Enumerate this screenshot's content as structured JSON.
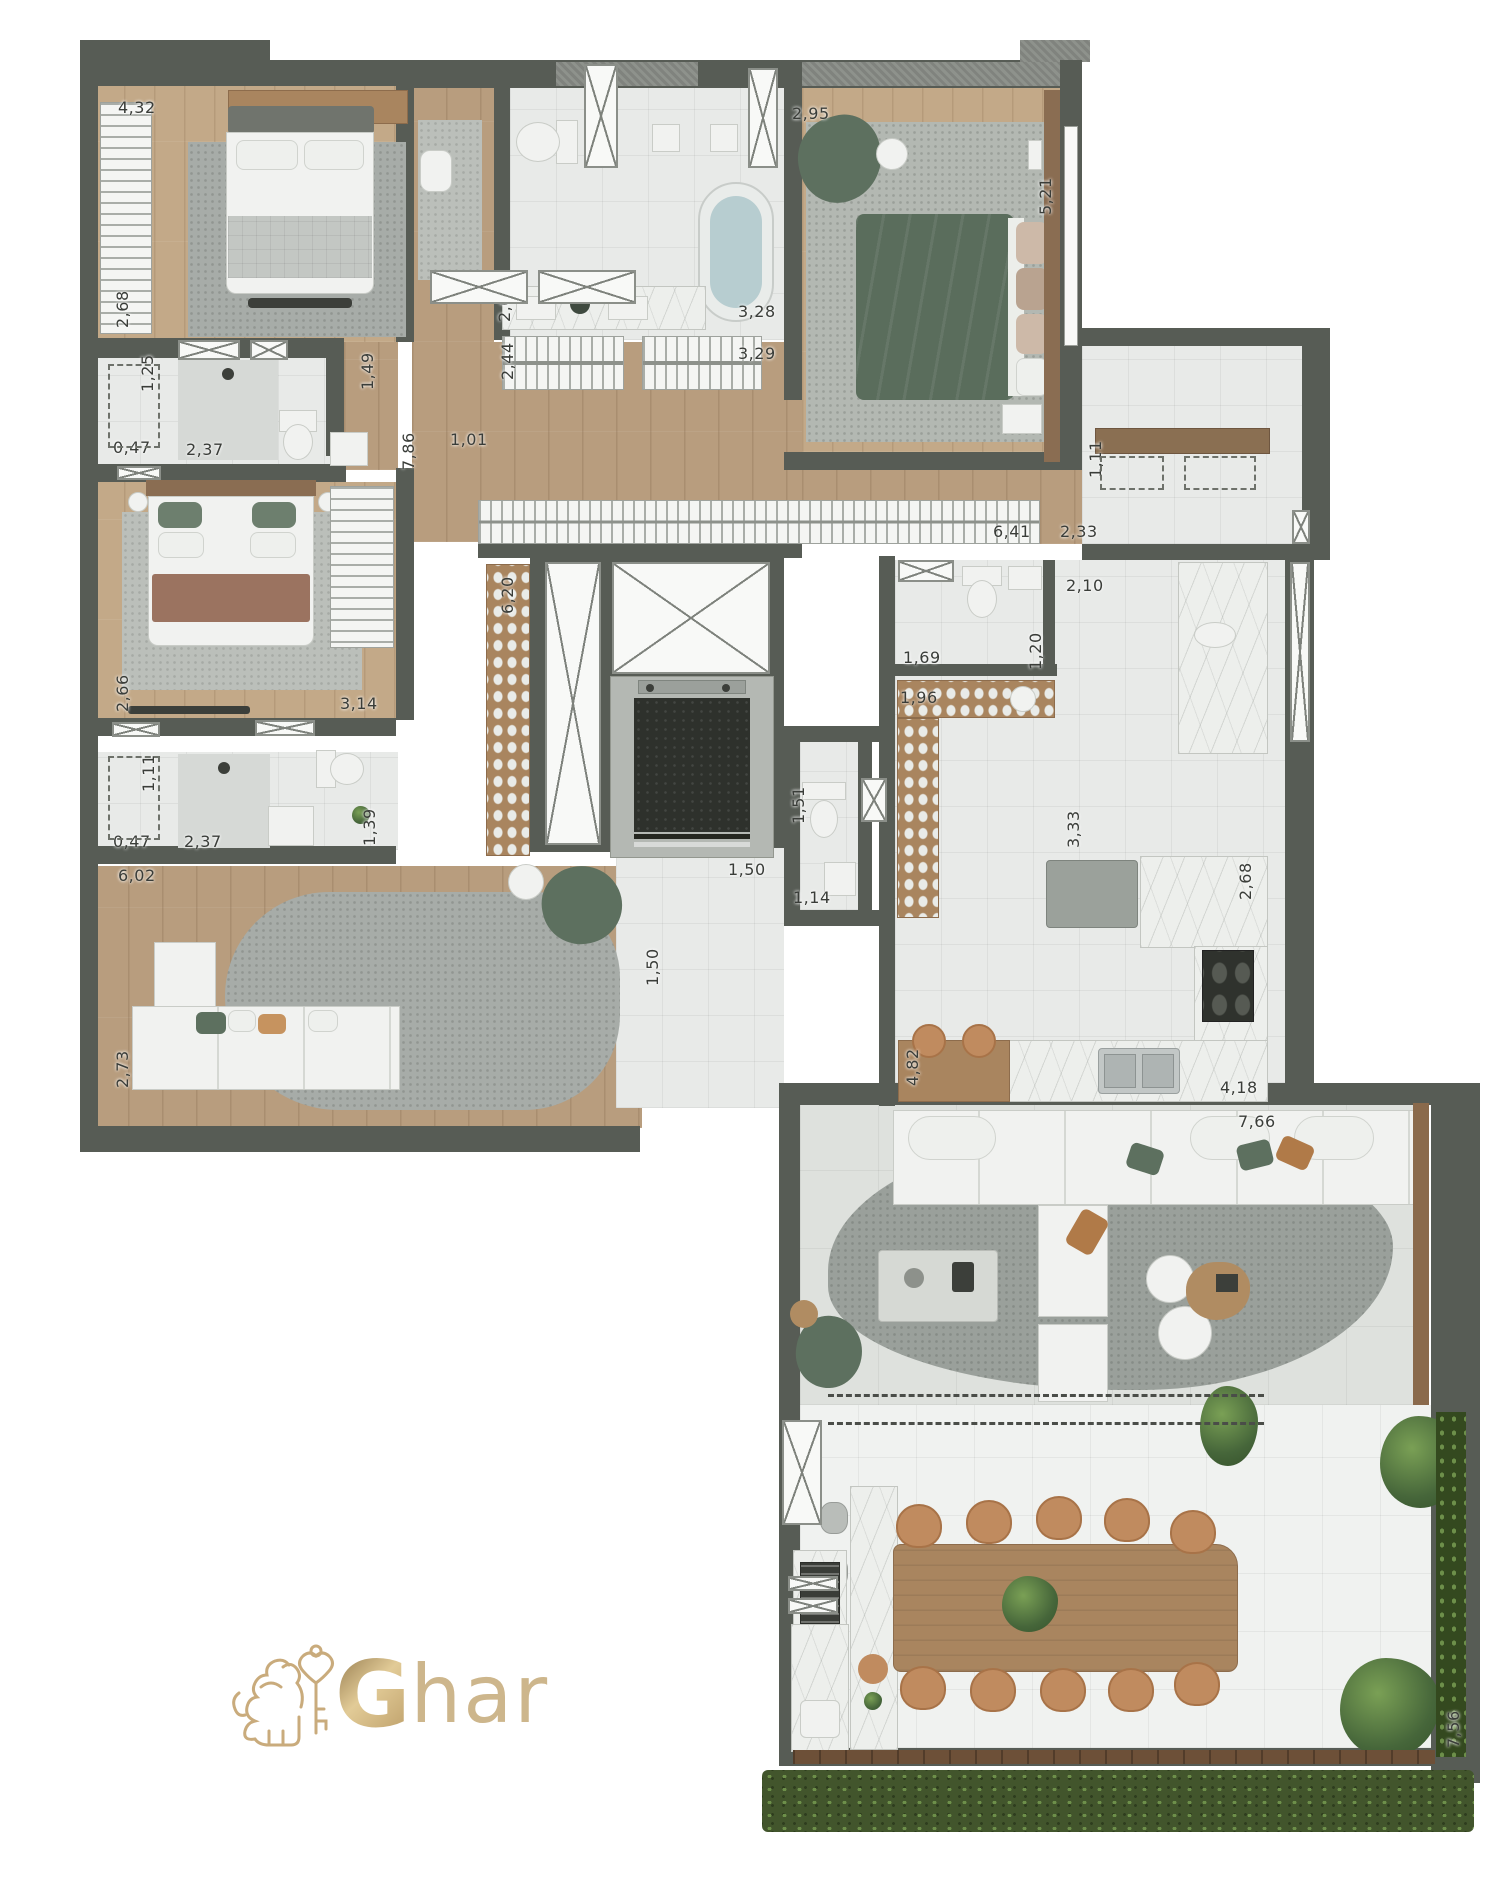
{
  "meta": {
    "kind": "apartment floor plan",
    "view": "top-down 3d render",
    "units": "meters"
  },
  "branding": {
    "logo_bold": "G",
    "logo_rest": "har",
    "emblem": "gold lion holding heart-shaped key"
  },
  "colors": {
    "wall": "#575c55",
    "wood_floor": "#b89d7e",
    "wood_floor_light": "#c3a988",
    "tile": "#e8eae8",
    "living_tile": "#dee1dd",
    "terrace_tile": "#f0f2f0",
    "marble": "#edefec",
    "rug": "#a7aca8",
    "green_furniture": "#5d705f",
    "green_duvet": "#5a6d5c",
    "tan_chair": "#c08b5f",
    "brown_blanket": "#9b7360",
    "hedge": "#42552c",
    "gold": "#c9ab7c",
    "dark_fixture": "#3c3f3a"
  },
  "rooms": [
    {
      "name": "bedroom-1"
    },
    {
      "name": "bathroom-1"
    },
    {
      "name": "bedroom-2"
    },
    {
      "name": "bathroom-2"
    },
    {
      "name": "family-room"
    },
    {
      "name": "walk-in-closet"
    },
    {
      "name": "master-bathroom"
    },
    {
      "name": "master-bedroom"
    },
    {
      "name": "laundry-service"
    },
    {
      "name": "kitchen"
    },
    {
      "name": "powder-room"
    },
    {
      "name": "hall-elevator"
    },
    {
      "name": "living-room"
    },
    {
      "name": "terrace-dining"
    }
  ],
  "dimensions": [
    {
      "value": "4,32",
      "x": 118,
      "y": 98,
      "vertical": false
    },
    {
      "value": "2,68",
      "x": 113,
      "y": 328,
      "vertical": true
    },
    {
      "value": "1,25",
      "x": 138,
      "y": 392,
      "vertical": true
    },
    {
      "value": "0,47",
      "x": 113,
      "y": 438,
      "vertical": false
    },
    {
      "value": "2,37",
      "x": 186,
      "y": 440,
      "vertical": false
    },
    {
      "value": "1,49",
      "x": 358,
      "y": 390,
      "vertical": true
    },
    {
      "value": "7,86",
      "x": 399,
      "y": 470,
      "vertical": true
    },
    {
      "value": "1,01",
      "x": 450,
      "y": 430,
      "vertical": false
    },
    {
      "value": "2,62",
      "x": 495,
      "y": 322,
      "vertical": true
    },
    {
      "value": "2,44",
      "x": 498,
      "y": 380,
      "vertical": true
    },
    {
      "value": "3,28",
      "x": 738,
      "y": 302,
      "vertical": false
    },
    {
      "value": "3,29",
      "x": 738,
      "y": 344,
      "vertical": false
    },
    {
      "value": "2,95",
      "x": 792,
      "y": 104,
      "vertical": false
    },
    {
      "value": "5,21",
      "x": 1036,
      "y": 215,
      "vertical": true
    },
    {
      "value": "6,20",
      "x": 498,
      "y": 614,
      "vertical": true
    },
    {
      "value": "6,41",
      "x": 993,
      "y": 522,
      "vertical": false
    },
    {
      "value": "2,33",
      "x": 1060,
      "y": 522,
      "vertical": false
    },
    {
      "value": "1,11",
      "x": 1086,
      "y": 478,
      "vertical": true
    },
    {
      "value": "2,10",
      "x": 1066,
      "y": 576,
      "vertical": false
    },
    {
      "value": "1,69",
      "x": 903,
      "y": 648,
      "vertical": false
    },
    {
      "value": "1,20",
      "x": 1026,
      "y": 670,
      "vertical": true
    },
    {
      "value": "1,96",
      "x": 900,
      "y": 688,
      "vertical": false
    },
    {
      "value": "3,33",
      "x": 1064,
      "y": 848,
      "vertical": true
    },
    {
      "value": "2,68",
      "x": 1236,
      "y": 900,
      "vertical": true
    },
    {
      "value": "4,82",
      "x": 903,
      "y": 1086,
      "vertical": true
    },
    {
      "value": "4,18",
      "x": 1220,
      "y": 1078,
      "vertical": false
    },
    {
      "value": "1,51",
      "x": 789,
      "y": 824,
      "vertical": true
    },
    {
      "value": "1,14",
      "x": 793,
      "y": 888,
      "vertical": false
    },
    {
      "value": "1,50",
      "x": 728,
      "y": 860,
      "vertical": false
    },
    {
      "value": "1,50",
      "x": 643,
      "y": 986,
      "vertical": true
    },
    {
      "value": "7,66",
      "x": 1238,
      "y": 1112,
      "vertical": false
    },
    {
      "value": "7,56",
      "x": 1444,
      "y": 1748,
      "vertical": true
    },
    {
      "value": "6,02",
      "x": 118,
      "y": 866,
      "vertical": false
    },
    {
      "value": "2,73",
      "x": 113,
      "y": 1088,
      "vertical": true
    },
    {
      "value": "2,66",
      "x": 113,
      "y": 712,
      "vertical": true
    },
    {
      "value": "3,14",
      "x": 340,
      "y": 694,
      "vertical": false
    },
    {
      "value": "1,11",
      "x": 139,
      "y": 792,
      "vertical": true
    },
    {
      "value": "0,47",
      "x": 113,
      "y": 832,
      "vertical": false
    },
    {
      "value": "2,37",
      "x": 184,
      "y": 832,
      "vertical": false
    },
    {
      "value": "1,39",
      "x": 360,
      "y": 846,
      "vertical": true
    }
  ],
  "windows": [
    {
      "x": 178,
      "y": 340,
      "w": 62,
      "h": 20
    },
    {
      "x": 250,
      "y": 340,
      "w": 38,
      "h": 20
    },
    {
      "x": 117,
      "y": 466,
      "w": 44,
      "h": 14
    },
    {
      "x": 112,
      "y": 722,
      "w": 48,
      "h": 15
    },
    {
      "x": 255,
      "y": 720,
      "w": 60,
      "h": 16
    },
    {
      "x": 584,
      "y": 64,
      "w": 34,
      "h": 104
    },
    {
      "x": 748,
      "y": 68,
      "w": 30,
      "h": 100
    },
    {
      "x": 545,
      "y": 562,
      "w": 56,
      "h": 283
    },
    {
      "x": 612,
      "y": 562,
      "w": 158,
      "h": 112
    },
    {
      "x": 861,
      "y": 778,
      "w": 26,
      "h": 44
    },
    {
      "x": 898,
      "y": 560,
      "w": 56,
      "h": 22
    },
    {
      "x": 1292,
      "y": 510,
      "w": 18,
      "h": 34
    },
    {
      "x": 1290,
      "y": 562,
      "w": 20,
      "h": 180
    },
    {
      "x": 782,
      "y": 1420,
      "w": 40,
      "h": 105
    },
    {
      "x": 788,
      "y": 1576,
      "w": 50,
      "h": 15
    },
    {
      "x": 788,
      "y": 1598,
      "w": 50,
      "h": 16
    },
    {
      "x": 430,
      "y": 270,
      "w": 98,
      "h": 34
    },
    {
      "x": 538,
      "y": 270,
      "w": 98,
      "h": 34
    }
  ],
  "dashed_boxes": [
    {
      "x": 108,
      "y": 364,
      "w": 52,
      "h": 84
    },
    {
      "x": 108,
      "y": 756,
      "w": 52,
      "h": 84
    },
    {
      "x": 1100,
      "y": 456,
      "w": 64,
      "h": 34
    },
    {
      "x": 1184,
      "y": 456,
      "w": 72,
      "h": 34
    }
  ]
}
